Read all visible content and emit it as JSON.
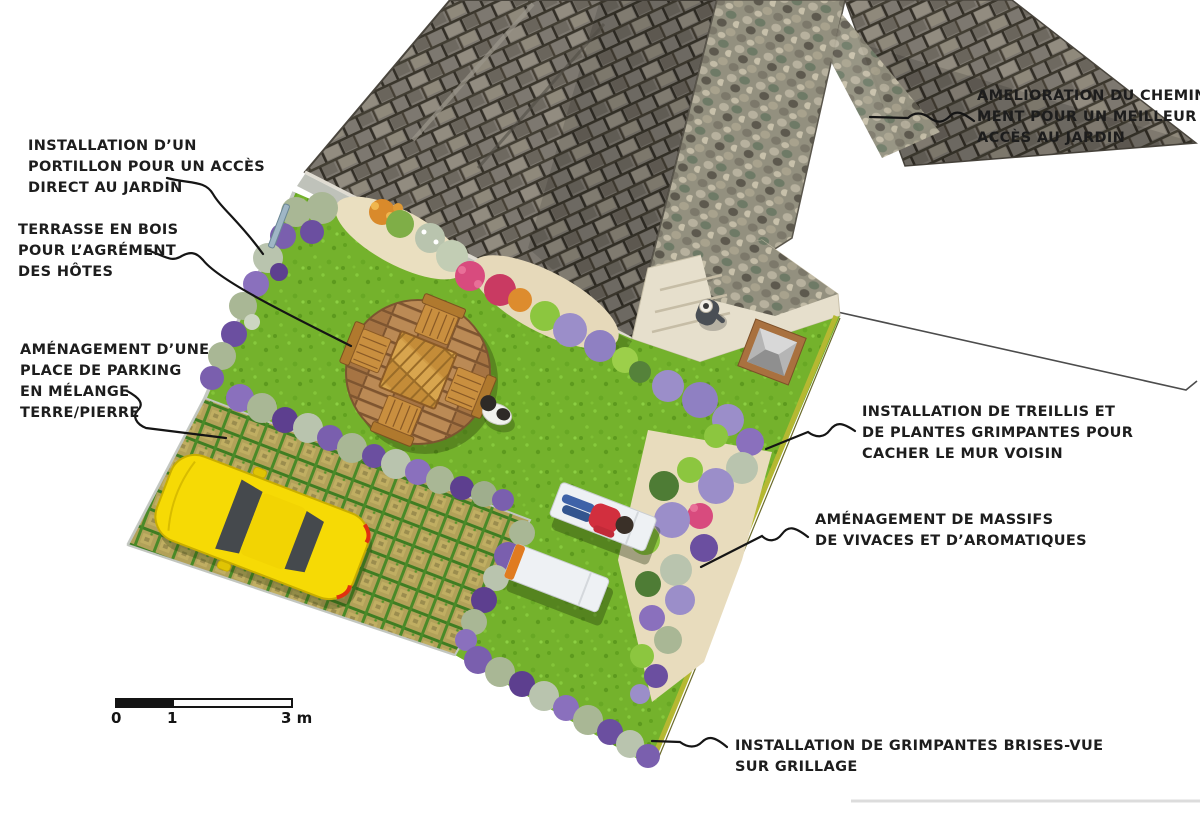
{
  "annotations": [
    {
      "id": "portillon",
      "lines": [
        "INSTALLATION D’UN",
        "PORTILLON POUR UN ACCÈS",
        "DIRECT AU JARDIN"
      ]
    },
    {
      "id": "terrasse",
      "lines": [
        "TERRASSE EN BOIS",
        "POUR L’AGRÉMENT",
        "DES HÔTES"
      ]
    },
    {
      "id": "parking",
      "lines": [
        "AMÉNAGEMENT D’UNE",
        "PLACE DE PARKING",
        "EN MÉLANGE",
        "TERRE/PIERRE"
      ]
    },
    {
      "id": "cheminement",
      "lines": [
        "AMELIORATION DU CHEMINE-",
        "MENT POUR UN MEILLEUR",
        "ACCÈS AU JARDIN"
      ]
    },
    {
      "id": "treillis",
      "lines": [
        "INSTALLATION DE TREILLIS ET",
        "DE PLANTES GRIMPANTES POUR",
        "CACHER LE MUR VOISIN"
      ]
    },
    {
      "id": "massifs",
      "lines": [
        "AMÉNAGEMENT DE MASSIFS",
        "DE VIVACES ET D’AROMATIQUES"
      ]
    },
    {
      "id": "grimpantes",
      "lines": [
        "INSTALLATION DE GRIMPANTES BRISES-VUE",
        "SUR GRILLAGE"
      ]
    }
  ],
  "scale_bar": {
    "labels": [
      "0",
      "1",
      "3 m"
    ]
  },
  "colors": {
    "lawn": "#74b22c",
    "roof_shingle": "#7d7870",
    "cobble_path": "#93907f",
    "deck_wood": "#b1804d",
    "table_wood": "#cf9a44",
    "car_yellow": "#f6da05",
    "lavender": "#9b8ec9",
    "purple": "#6b4fa0",
    "violet": "#7a5fae",
    "pink": "#d84b7e",
    "red": "#c93a62",
    "orange": "#d98a2b",
    "foliage_gray": "#a9b795",
    "foliage_bright": "#8cc63f",
    "foliage_dark": "#4e7c35",
    "parking_soil": "#b2a159",
    "annotation_line": "#151515"
  }
}
